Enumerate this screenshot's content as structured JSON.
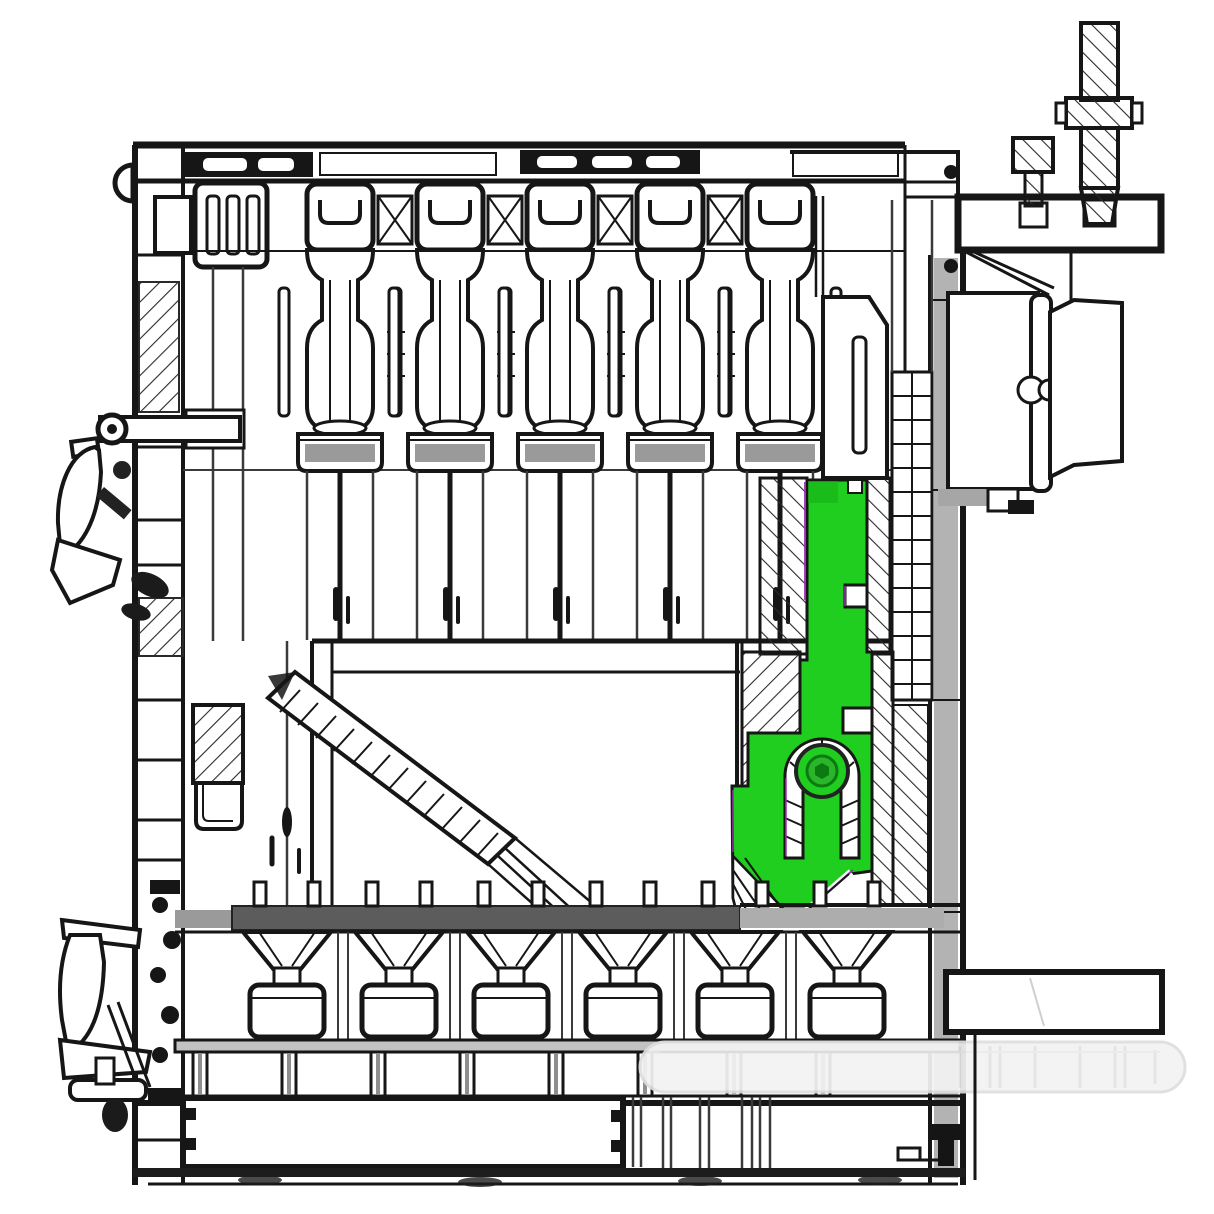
{
  "meta": {
    "title": "Sectional solid-fuel boiler — cross-section technical drawing",
    "drawing_type": "engineering cross-section, monochrome line art with one highlighted part",
    "canvas": {
      "width": 1214,
      "height": 1214
    }
  },
  "colors": {
    "bg": "#ffffff",
    "ink": "#161616",
    "inksoft": "#3a3a3a",
    "metal": "#a6a6a6",
    "grayfill": "#9a9a9a",
    "darkbar": "#5c5c5c",
    "hl": "#1fce1f",
    "hlmid": "#2bb52b",
    "hldark": "#0c7a12",
    "accent": "#9b30b5",
    "ghost": "#f3f3f3",
    "ghoststroke": "#dedede"
  },
  "highlighted_part": {
    "name": "feed-lever-bracket",
    "fill": "#1fce1f",
    "bounds": {
      "x": 732,
      "y": 478,
      "width": 160,
      "height": 444
    },
    "features": [
      "stepped-column",
      "arched-pin-slot",
      "pivot-bolt",
      "hatched-wedge-cut"
    ]
  },
  "parts": [
    {
      "name": "boiler-casing",
      "fill": "outline"
    },
    {
      "name": "top-heat-exchanger-sections",
      "count": 5,
      "pitch_px": 110
    },
    {
      "name": "left-start-section-block",
      "slots": 3
    },
    {
      "name": "loading-chute-hatched",
      "angle": "down-right"
    },
    {
      "name": "threaded-adjuster-bolt",
      "hatch": "diagonal"
    },
    {
      "name": "top-right-mounting-plate",
      "fill": "white"
    },
    {
      "name": "side-cleanout-door-box",
      "hinge_circles": 2
    },
    {
      "name": "fire-grate-bar",
      "fill": "#5c5c5c"
    },
    {
      "name": "grate-funnels",
      "count": 6
    },
    {
      "name": "lower-section-pots",
      "count": 6
    },
    {
      "name": "ash-chamber",
      "tabs": 4
    },
    {
      "name": "operating-handle-upper",
      "side": "left"
    },
    {
      "name": "operating-handle-lower",
      "side": "left"
    },
    {
      "name": "pivot-pin-rod",
      "side": "left"
    },
    {
      "name": "side-support-bar",
      "side": "right"
    },
    {
      "name": "faded-ghost-cylinder",
      "fill": "#f3f3f3"
    }
  ]
}
